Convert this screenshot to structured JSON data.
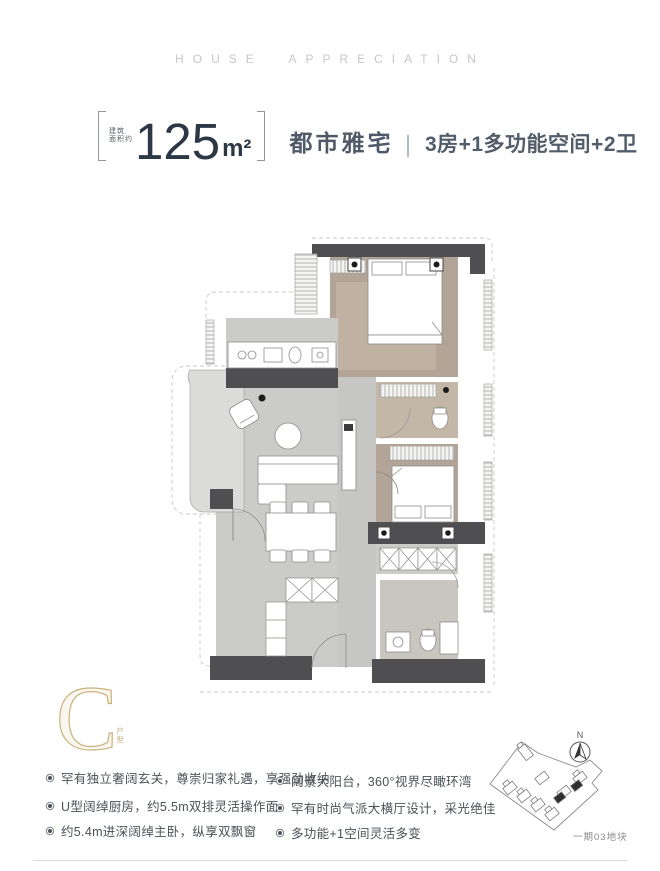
{
  "header": {
    "title": "HOUSE APPRECIATION"
  },
  "title_block": {
    "area_label_line1": "建筑",
    "area_label_line2": "面积约",
    "area_value": "125",
    "area_unit": "m²",
    "estate_type": "都市雅宅",
    "layout_desc": "3房+1多功能空间+2卫"
  },
  "unit_badge": {
    "letter": "C",
    "caption": "户型"
  },
  "features": {
    "left": [
      "罕有独立奢阔玄关，尊崇归家礼遇，享强劲收纳",
      "U型阔绰厨房，约5.5m双排灵活操作面",
      "约5.4m进深阔绰主卧，纵享双飘窗"
    ],
    "right": [
      "阔景大阳台，360°视界尽瞰环湾",
      "罕有时尚气派大横厅设计，采光绝佳",
      "多功能+1空间灵活多变"
    ]
  },
  "site_map": {
    "compass": "N",
    "plot_label": "一期03地块"
  },
  "colors": {
    "accent_gold": "#c9b27c",
    "title_navy": "#2d3847",
    "text_gray": "#4b5157",
    "header_gray": "#c7c7c7",
    "wall_dark": "#4f4f51",
    "floor_tan": "#b2a496",
    "floor_gray": "#cbcbc9",
    "balcony_gray": "#dbdbd9"
  }
}
